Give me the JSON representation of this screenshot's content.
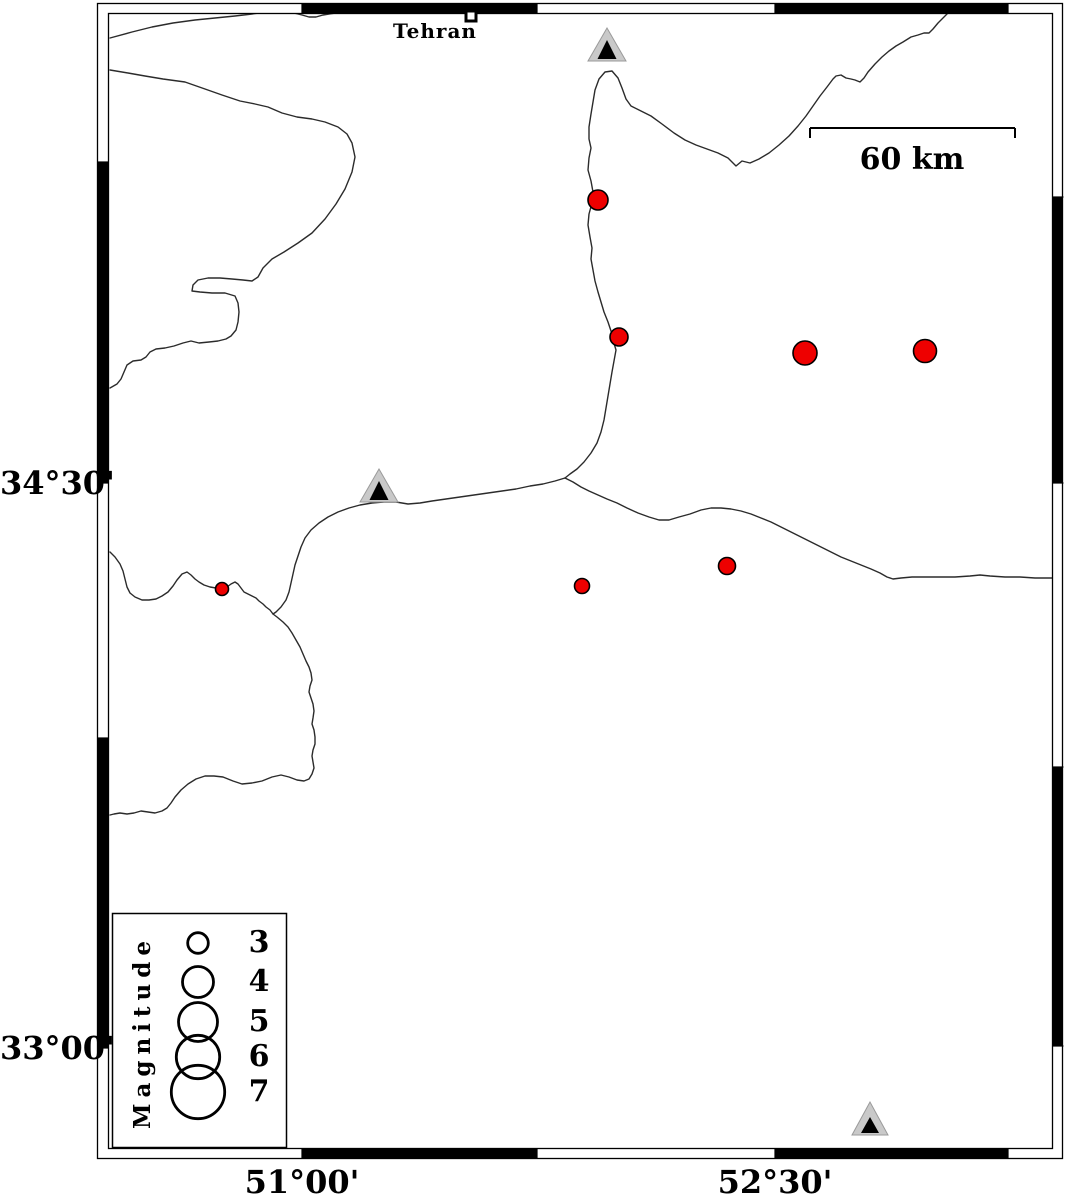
{
  "map": {
    "title_note": "seismicity map with stations and scale",
    "city": {
      "label": "Tehran",
      "x": 471,
      "y": 16,
      "symbol": "open-square"
    },
    "scalebar": {
      "label": "60 km",
      "x1": 810,
      "x2": 1015,
      "y": 128,
      "tick_len": 10
    },
    "axis": {
      "left": [
        {
          "label": "34°30'",
          "y": 483
        },
        {
          "label": "33°00'",
          "y": 1048
        }
      ],
      "bottom": [
        {
          "label": "51°00'",
          "x": 302
        },
        {
          "label": "52°30'",
          "x": 775
        }
      ]
    },
    "legend": {
      "title": "Magnitude",
      "box": {
        "x": 112,
        "y": 913,
        "w": 174,
        "h": 234
      },
      "circle_cx": 198,
      "entries": [
        {
          "label": "3",
          "r": 10.3,
          "cy": 943
        },
        {
          "label": "4",
          "r": 15.5,
          "cy": 982
        },
        {
          "label": "5",
          "r": 19.5,
          "cy": 1022
        },
        {
          "label": "6",
          "r": 21.7,
          "cy": 1057
        },
        {
          "label": "7",
          "r": 26.7,
          "cy": 1092
        }
      ]
    },
    "stations": [
      {
        "x": 607,
        "base_y": 61,
        "w": 38,
        "h": 33,
        "inner_w": 19,
        "inner_h": 19
      },
      {
        "x": 379,
        "base_y": 502,
        "w": 38,
        "h": 33,
        "inner_w": 19,
        "inner_h": 19
      },
      {
        "x": 870,
        "base_y": 1135,
        "w": 36,
        "h": 33,
        "inner_w": 18,
        "inner_h": 16
      }
    ],
    "earthquakes": [
      {
        "x": 598,
        "y": 200,
        "r": 10
      },
      {
        "x": 619,
        "y": 337,
        "r": 9
      },
      {
        "x": 805,
        "y": 353,
        "r": 12
      },
      {
        "x": 925,
        "y": 351,
        "r": 11.5
      },
      {
        "x": 727,
        "y": 566,
        "r": 8.5
      },
      {
        "x": 582,
        "y": 586,
        "r": 7.5
      },
      {
        "x": 222,
        "y": 589,
        "r": 6.5
      }
    ],
    "boundaries": [
      {
        "id": "northwest-short",
        "points": "110,38 132,32 152,27 173,23 195,20 215,18 235,16 252,14 266,12"
      },
      {
        "id": "top-dip",
        "points": "294,13 302,15 309,17 316,17 323,15 329,14 336,13"
      },
      {
        "id": "west-province",
        "points": "110,70 128,73 145,76 163,79 185,82 205,89 222,95 240,101 255,104 268,107 282,113 297,117 312,119 325,122 338,127 347,134 352,143 355,157 352,172 345,189 336,204 325,219 312,233 298,243 284,252 272,259 263,268 258,277 252,281 243,280 232,279 220,278 208,278 198,280 193,285 192,291 200,292 212,293 225,293 235,296 238,303 239,312 238,322 236,330 231,336 226,339 218,341 209,342 199,343 191,341 183,343 174,346 165,348 156,349 150,352 146,357 141,360 133,361 127,365 124,372 121,379 117,384 110,388"
      },
      {
        "id": "north-province",
        "points": "950,11 944,17 938,23 933,29 929,33 924,33 918,35 911,37 903,42 896,46 889,51 882,57 875,64 868,72 864,78 860,82 855,80 851,79 846,78 841,75 836,76 833,79 827,87 820,96 813,106 806,116 798,126 789,136 779,145 769,153 759,159 750,163 742,161 736,166 728,158 718,153 707,149 696,145 685,140 674,133 662,124 651,116 641,111 631,106 626,99 622,88 618,78 612,71 605,72 599,79 595,90 593,102 591,114 589,127 589,139 591,148 589,158 588,170 591,181 593,192 592,203 589,214 588,225 590,237 592,248 591,259 593,270 595,281 598,292 601,302 604,312 608,322 611,331 613,340 616,350 614,361 612,372 610,384 608,396 606,408 604,420 601,432 597,443 591,453 584,462 577,469 570,474 565,478"
      },
      {
        "id": "southwest-province",
        "points": "565,478 555,481 543,484 530,486 516,489 502,491 488,493 474,495 460,497 446,499 432,501 420,503 408,504 396,502 384,502 372,503 360,505 349,508 338,512 328,517 319,523 311,530 305,538 301,547 298,556 295,565 293,574 291,583 289,592 286,600 281,607 276,612 273,614 277,617 283,622 288,627 292,633 296,640 300,647 303,654 306,661 309,667 311,673 312,680 310,686 309,692 311,698 313,704 314,711 313,718 312,724 314,730 315,737 315,744 313,750 312,756 313,762 314,768 312,774 309,779 304,781 297,780 289,777 281,775 272,777 262,781 252,783 242,784 233,781 223,777 214,776 205,776 196,779 188,784 181,790 175,797 171,803 167,808 162,811 155,813 148,812 141,811 134,813 127,814 120,813 114,814 110,815"
      },
      {
        "id": "west-wiggle",
        "points": "110,552 115,557 120,564 123,571 125,579 127,587 130,593 135,597 142,600 149,600 156,599 162,596 168,592 173,586 177,580 182,574 187,572 191,575 195,579 199,582 204,585 210,587 216,588 222,589 227,587 231,584 235,582 238,584 241,588 244,592 248,594 252,596 256,598 259,601 263,604 266,607 270,610 273,614"
      },
      {
        "id": "east-province",
        "points": "565,478 573,482 581,487 589,491 598,495 607,499 617,503 627,508 638,513 649,517 659,520 669,520 679,517 690,514 701,510 711,508 721,508 731,509 741,511 751,514 761,518 771,522 781,527 791,532 801,537 811,542 821,547 831,552 841,557 851,561 861,565 871,569 880,573 887,577 893,579 901,578 912,577 925,577 940,577 955,577 970,576 980,575 990,576 1005,577 1020,577 1035,578 1053,578"
      }
    ],
    "colors": {
      "earthquake_fill": "#ee0000",
      "earthquake_stroke": "#000000",
      "station_fill": "#c9c9c9",
      "station_stroke": "#9a9a9a",
      "station_inner": "#000000",
      "boundary_line": "#2b2b2b",
      "frame": "#000000",
      "background": "#ffffff"
    }
  }
}
